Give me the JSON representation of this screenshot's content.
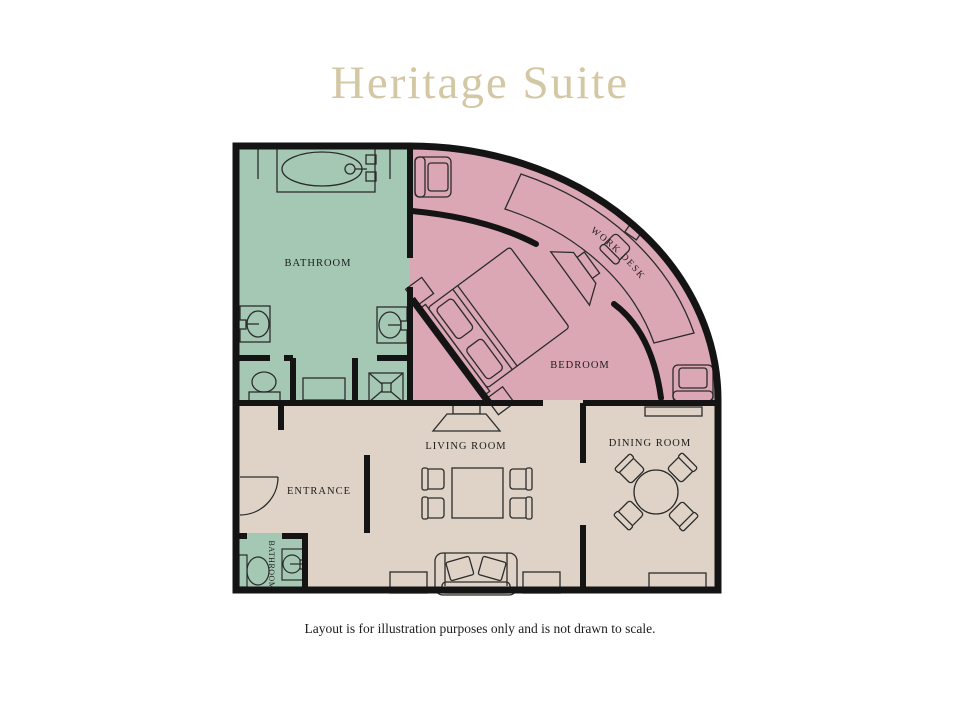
{
  "title": "Heritage Suite",
  "caption": "Layout is for illustration purposes only and is not drawn to scale.",
  "colors": {
    "title_text": "#d3c7a4",
    "wall": "#141414",
    "line": "#2b2b2b",
    "label_text": "#1c1c1c",
    "bathroom_fill": "#a5c8b5",
    "bedroom_fill": "#dca7b5",
    "living_fill": "#ded3c6"
  },
  "rooms": {
    "bathroom": {
      "label": "BATHROOM"
    },
    "bedroom": {
      "label": "BEDROOM"
    },
    "work_desk": {
      "label": "WORK DESK"
    },
    "living_room": {
      "label": "LIVING ROOM"
    },
    "dining_room": {
      "label": "DINING ROOM"
    },
    "entrance": {
      "label": "ENTRANCE"
    },
    "guest_bathroom": {
      "label": "BATHROOM"
    }
  }
}
